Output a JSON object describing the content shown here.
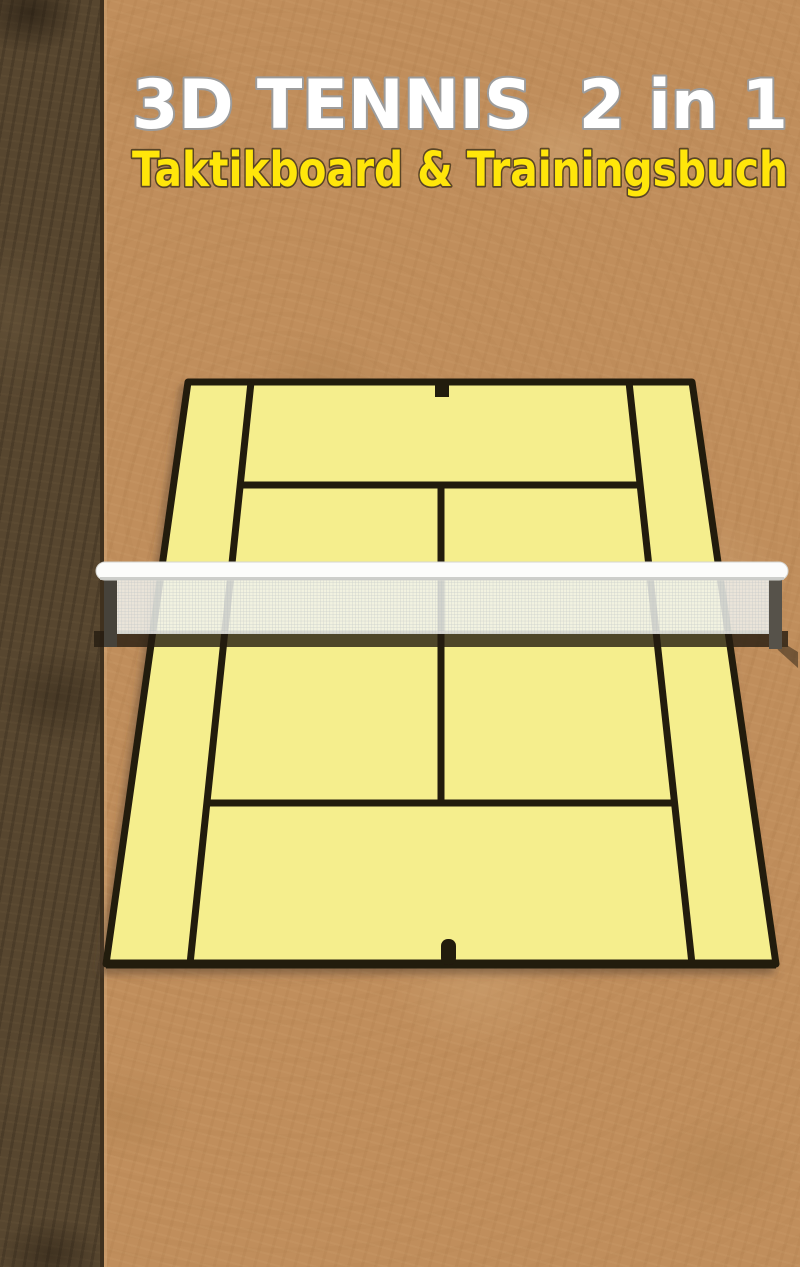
{
  "cover": {
    "title": "3D TENNIS  2 in 1",
    "subtitle": "Taktikboard & Trainingsbuch",
    "title_color": "#ffffff",
    "title_outline": "#9c9c9c",
    "subtitle_color": "#ffe60a",
    "subtitle_outline": "#5a4526"
  },
  "background": {
    "cork_color": "#c08e5c",
    "spine_color": "#57462f"
  },
  "court": {
    "fill": "#f5ee8d",
    "line_color": "#241a0c",
    "net": {
      "band_color": "#fcfcfb",
      "mesh_color": "#f1f2ee",
      "post_color": "#46423a",
      "shadow_color": "#241b10"
    }
  }
}
